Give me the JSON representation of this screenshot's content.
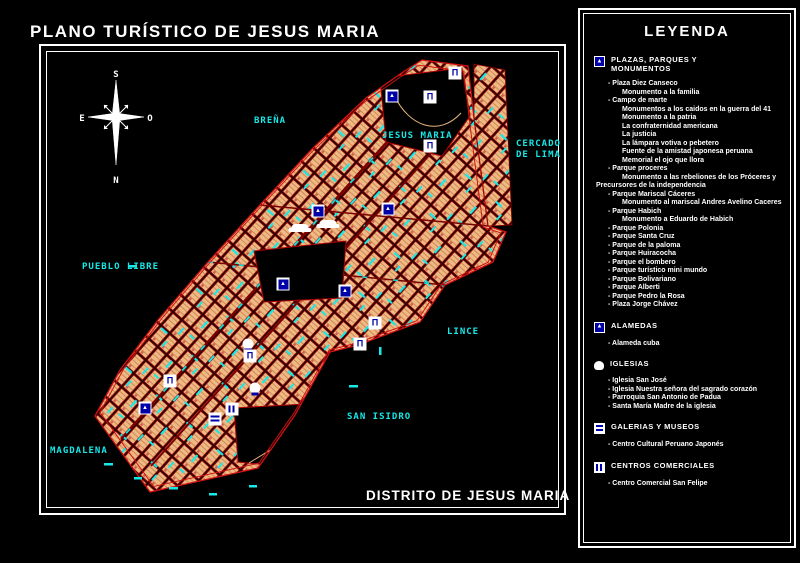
{
  "title": "PLANO TURÍSTICO DE JESUS MARIA",
  "map": {
    "subtitle": "DISTRITO DE JESUS MARIA",
    "compass": {
      "north": "N",
      "south": "S",
      "east": "E",
      "west": "O"
    },
    "labels": [
      {
        "text": "BREÑA",
        "x": 254,
        "y": 116
      },
      {
        "text": "JESUS MARIA",
        "x": 382,
        "y": 131
      },
      {
        "text": "CERCADO\nDE LIMA",
        "x": 516,
        "y": 139
      },
      {
        "text": "PUEBLO LIBRE",
        "x": 82,
        "y": 262
      },
      {
        "text": "LINCE",
        "x": 447,
        "y": 327
      },
      {
        "text": "SAN ISIDRO",
        "x": 347,
        "y": 412
      },
      {
        "text": "MAGDALENA",
        "x": 50,
        "y": 446
      }
    ],
    "icons": [
      {
        "x": 455,
        "y": 73,
        "type": "church"
      },
      {
        "x": 430,
        "y": 97,
        "type": "church"
      },
      {
        "x": 392,
        "y": 96,
        "type": "park"
      },
      {
        "x": 430,
        "y": 146,
        "type": "church"
      },
      {
        "x": 318,
        "y": 211,
        "type": "park"
      },
      {
        "x": 388,
        "y": 209,
        "type": "park"
      },
      {
        "x": 300,
        "y": 228,
        "type": "cloud"
      },
      {
        "x": 328,
        "y": 224,
        "type": "cloud"
      },
      {
        "x": 283,
        "y": 284,
        "type": "park"
      },
      {
        "x": 345,
        "y": 291,
        "type": "park"
      },
      {
        "x": 375,
        "y": 323,
        "type": "church"
      },
      {
        "x": 360,
        "y": 344,
        "type": "church"
      },
      {
        "x": 248,
        "y": 344,
        "type": "dome"
      },
      {
        "x": 250,
        "y": 356,
        "type": "church"
      },
      {
        "x": 170,
        "y": 381,
        "type": "church"
      },
      {
        "x": 145,
        "y": 408,
        "type": "park"
      },
      {
        "x": 232,
        "y": 409,
        "type": "mall"
      },
      {
        "x": 215,
        "y": 419,
        "type": "museum"
      },
      {
        "x": 255,
        "y": 388,
        "type": "dome"
      }
    ]
  },
  "legend": {
    "title": "LEYENDA",
    "sections": [
      {
        "icon": "park",
        "title": "PLAZAS, PARQUES Y MONUMENTOS",
        "items": [
          {
            "t": "- Plaza Diez Canseco",
            "lvl": 1
          },
          {
            "t": "Monumento a la familia",
            "lvl": 2
          },
          {
            "t": "- Campo de marte",
            "lvl": 1
          },
          {
            "t": "Monumentos a los caidos en la guerra del 41",
            "lvl": 2
          },
          {
            "t": "Monumento a la patria",
            "lvl": 2
          },
          {
            "t": "La confraternidad americana",
            "lvl": 2
          },
          {
            "t": "La justicia",
            "lvl": 2
          },
          {
            "t": "La lámpara votiva o pebetero",
            "lvl": 2
          },
          {
            "t": "Fuente de la amistad japonesa peruana",
            "lvl": 2
          },
          {
            "t": "Memorial el ojo que llora",
            "lvl": 2
          },
          {
            "t": "- Parque proceres",
            "lvl": 1
          },
          {
            "t": "Monumento a las rebeliones de los Próceres y Precursores de la independencia",
            "lvl": 2
          },
          {
            "t": "- Parque Mariscal Cáceres",
            "lvl": 1
          },
          {
            "t": "Monumento al mariscal Andres Avelino Caceres",
            "lvl": 2
          },
          {
            "t": "- Parque Habich",
            "lvl": 1
          },
          {
            "t": "Monumento a Eduardo de Habich",
            "lvl": 2
          },
          {
            "t": "- Parque Polonia",
            "lvl": 1
          },
          {
            "t": "- Parque Santa Cruz",
            "lvl": 1
          },
          {
            "t": "- Parque de la paloma",
            "lvl": 1
          },
          {
            "t": "- Parque Huiracocha",
            "lvl": 1
          },
          {
            "t": "- Parque el bombero",
            "lvl": 1
          },
          {
            "t": "- Parque turístico mini mundo",
            "lvl": 1
          },
          {
            "t": "- Parque Bolivariano",
            "lvl": 1
          },
          {
            "t": "- Parque Alberti",
            "lvl": 1
          },
          {
            "t": "- Parque Pedro la Rosa",
            "lvl": 1
          },
          {
            "t": "- Plaza Jorge Chávez",
            "lvl": 1
          }
        ]
      },
      {
        "icon": "alameda",
        "title": "ALAMEDAS",
        "items": [
          {
            "t": "- Alameda cuba",
            "lvl": 1
          }
        ]
      },
      {
        "icon": "church",
        "title": "IGLESIAS",
        "items": [
          {
            "t": "- Iglesia San José",
            "lvl": 1
          },
          {
            "t": "- Iglesia Nuestra señora del sagrado corazón",
            "lvl": 1
          },
          {
            "t": "- Parroquia San Antonio de Padua",
            "lvl": 1
          },
          {
            "t": "- Santa María Madre de la iglesia",
            "lvl": 1
          }
        ]
      },
      {
        "icon": "museum",
        "title": "GALERIAS Y MUSEOS",
        "items": [
          {
            "t": "- Centro Cultural Peruano Japonés",
            "lvl": 1
          }
        ]
      },
      {
        "icon": "mall",
        "title": "CENTROS COMERCIALES",
        "items": [
          {
            "t": "- Centro Comercial San Felipe",
            "lvl": 1
          }
        ]
      }
    ]
  },
  "colors": {
    "background": "#000000",
    "frame": "#ffffff",
    "district_outline": "#cc1111",
    "street_grid": "#8b0000",
    "blocks": "#edba84",
    "cyan_features": "#17e8e8",
    "icon_blue": "#0000a8",
    "text": "#ffffff"
  }
}
